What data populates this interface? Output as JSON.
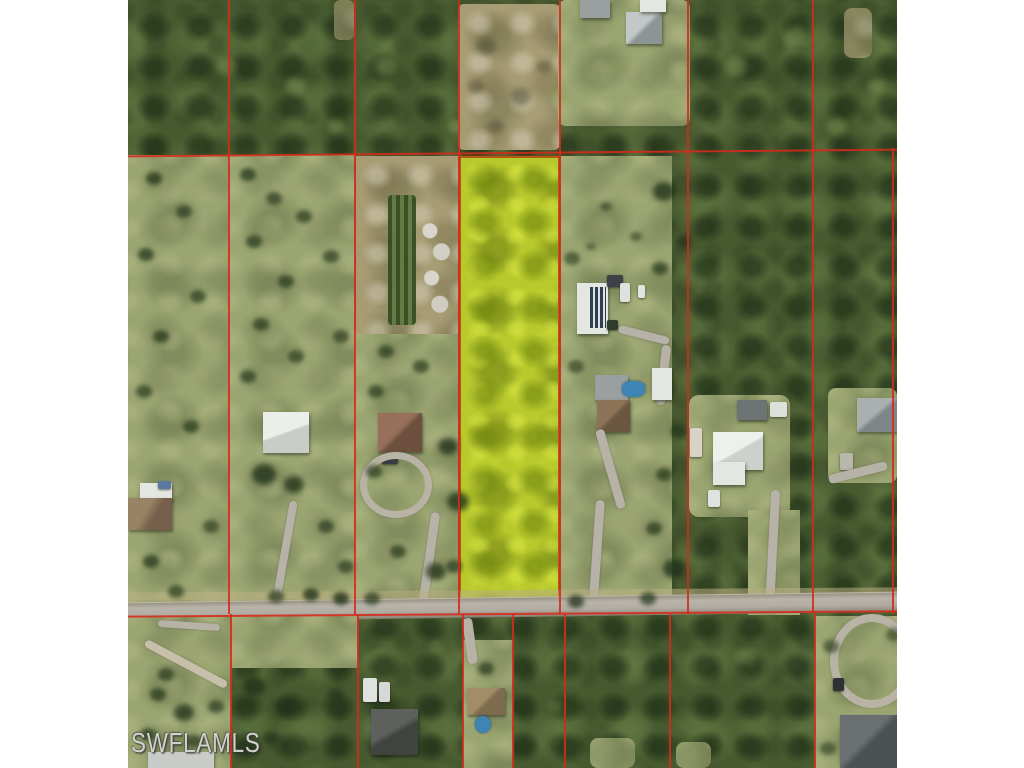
{
  "watermark": {
    "label": "SWFLAMLS"
  },
  "colors": {
    "canvas": "#ffffff",
    "parcel_line": "#d62a1b",
    "highlight": "#b7c92c",
    "highlight_border": "#b05a12",
    "forest": "#47592f",
    "grass": "#9aa571",
    "sand": "#a79c74",
    "road": "#b3afa5",
    "pool": "#3e85b5"
  },
  "photo": {
    "left": 128,
    "top": 0,
    "width": 769,
    "height": 768
  },
  "map": {
    "type": "aerial-parcel-view",
    "subject_parcel": {
      "left": 331,
      "top": 156,
      "width": 101,
      "height": 458
    },
    "lines": [
      {
        "l": 100,
        "t": 0,
        "w": 2,
        "h": 614,
        "r": 0
      },
      {
        "l": 226,
        "t": 0,
        "w": 2,
        "h": 614,
        "r": 0
      },
      {
        "l": 330,
        "t": 0,
        "w": 2,
        "h": 614,
        "r": 0
      },
      {
        "l": 431,
        "t": 0,
        "w": 2,
        "h": 614,
        "r": 0
      },
      {
        "l": 559,
        "t": 0,
        "w": 2,
        "h": 614,
        "r": 0
      },
      {
        "l": 684,
        "t": 0,
        "w": 2,
        "h": 614,
        "r": 0
      },
      {
        "l": 764,
        "t": 148,
        "w": 2,
        "h": 466,
        "r": 0
      },
      {
        "l": 102,
        "t": 614,
        "w": 2,
        "h": 154,
        "r": 0
      },
      {
        "l": 229,
        "t": 614,
        "w": 2,
        "h": 154,
        "r": 0
      },
      {
        "l": 334,
        "t": 614,
        "w": 2,
        "h": 154,
        "r": 0
      },
      {
        "l": 384,
        "t": 614,
        "w": 2,
        "h": 154,
        "r": 0
      },
      {
        "l": 436,
        "t": 614,
        "w": 2,
        "h": 154,
        "r": 0
      },
      {
        "l": 541,
        "t": 614,
        "w": 2,
        "h": 154,
        "r": 0
      },
      {
        "l": 686,
        "t": 614,
        "w": 2,
        "h": 154,
        "r": 0
      },
      {
        "l": 0,
        "t": 152,
        "w": 769,
        "h": 2,
        "r": -0.5
      },
      {
        "l": 0,
        "t": 613,
        "w": 769,
        "h": 2,
        "r": -0.4
      }
    ]
  }
}
